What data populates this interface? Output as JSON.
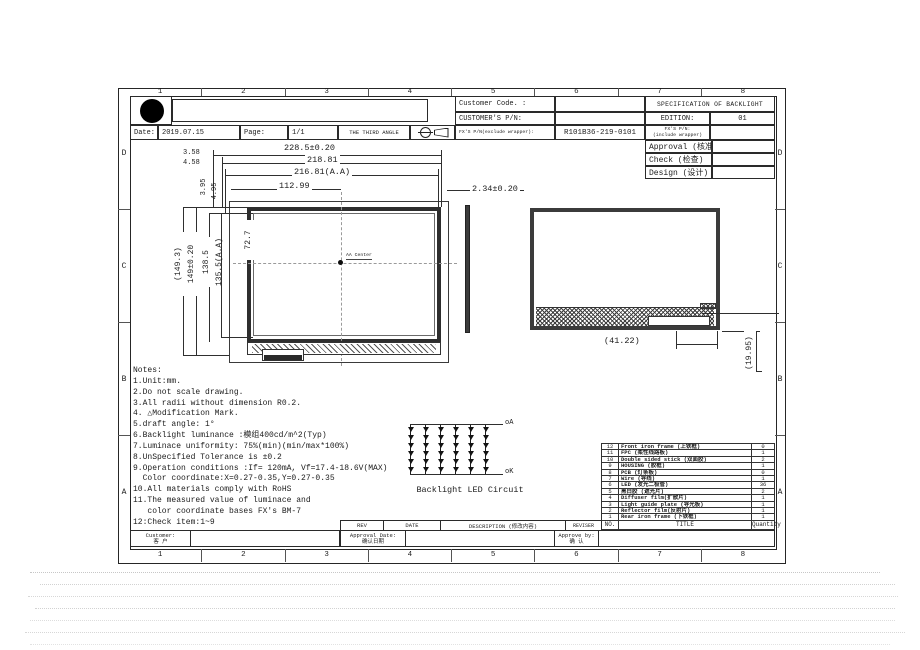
{
  "colors": {
    "ink": "#1c1c1c",
    "paper": "#ffffff"
  },
  "sheet": {
    "zone_cols": [
      "1",
      "2",
      "3",
      "4",
      "5",
      "6",
      "7",
      "8"
    ],
    "zone_rows": [
      "D",
      "C",
      "B",
      "A"
    ]
  },
  "title_block": {
    "customer_code_label": "Customer Code. :",
    "customer_pn_label": "CUSTOMER'S P/N:",
    "spec_title": "SPECIFICATION OF BACKLIGHT",
    "edition_label": "EDITION:",
    "edition_value": "01",
    "date_label": "Date:",
    "date_value": "2019.07.15",
    "page_label": "Page:",
    "page_value": "1/1",
    "third_angle_label": "THE THIRD ANGLE",
    "fx_pn_exclude_label": "FX'S P/N(exclude wrapper):",
    "fx_pn_value": "R101B36-219-0101",
    "fx_pn_include_label_1": "FX'S P/N:",
    "fx_pn_include_label_2": "(include wrapper)",
    "approval_label": "Approval (核准)",
    "check_label": "Check (检查)",
    "design_label": "Design (设计)"
  },
  "dims": {
    "width_overall": "228.5±0.20",
    "width_outline": "218.81",
    "width_aa": "216.81(A.A)",
    "width_half": "112.99",
    "top_offset1": "3.58",
    "top_offset2": "4.58",
    "side_offset1": "3.95",
    "side_offset2": "4.95",
    "height_overall_ref": "(149.3)",
    "height_overall": "149±0.20",
    "height_outline": "138.5",
    "height_aa": "135.5(A.A)",
    "height_half": "72.7",
    "thickness": "2.34±0.20",
    "fpc_offset": "(41.22)",
    "fpc_height": "(19.95)",
    "aa_center_label": "AA Center"
  },
  "notes": {
    "lines": [
      "Notes:",
      "1.Unit:mm.",
      "2.Do not scale drawing.",
      "3.All radii without dimension R0.2.",
      "4. △Modification Mark.",
      "5.draft angle: 1°",
      "6.Backlight luminance :模组400cd/m^2(Typ)",
      "7.Luminace uniformity: 75%(min)(min/max*100%)",
      "8.UnSpecified Tolerance is ±0.2",
      "9.Operation conditions :If= 120mA, Vf=17.4-18.6V(MAX)",
      "  Color coordinate:X=0.27-0.35,Y=0.27-0.35",
      "10.All materials comply with RoHS",
      "11.The measured value of luminace and",
      "   color coordinate bases FX's BM-7",
      "12:Check item:1~9"
    ]
  },
  "led_circuit": {
    "anode_label": "oA",
    "cathode_label": "oK",
    "caption": "Backlight LED Circuit",
    "columns": 6,
    "rows_per_column": 6
  },
  "parts_table": {
    "header": {
      "no": "NO.",
      "title": "TITLE",
      "qty": "Quantity"
    },
    "rows": [
      {
        "no": "12",
        "title": "Front iron frame (上铁框)",
        "qty": "0"
      },
      {
        "no": "11",
        "title": "FPC (柔性线路板)",
        "qty": "1"
      },
      {
        "no": "10",
        "title": "Double sided stick (双面胶)",
        "qty": "2"
      },
      {
        "no": "9",
        "title": "HOUSING (胶框)",
        "qty": "1"
      },
      {
        "no": "8",
        "title": "PCB (灯条板)",
        "qty": "0"
      },
      {
        "no": "7",
        "title": "Wire (导线)",
        "qty": "1"
      },
      {
        "no": "6",
        "title": "LED (发光二极管)",
        "qty": "36"
      },
      {
        "no": "5",
        "title": "黑白胶 (遮光片)",
        "qty": "2"
      },
      {
        "no": "4",
        "title": "Diffuser film(扩散片)",
        "qty": "1"
      },
      {
        "no": "3",
        "title": "Light guide plate (导光板)",
        "qty": "1"
      },
      {
        "no": "2",
        "title": "Reflector film(反射片)",
        "qty": "1"
      },
      {
        "no": "1",
        "title": "Rear iron frame (下铁框)",
        "qty": "1"
      }
    ]
  },
  "revision_table": {
    "rev_label": "REV",
    "date_label": "DATE",
    "description_label": "DESCRIPTION  (修改内容)",
    "reviser_label": "REVISER",
    "approval_date_label": "Approval Date:",
    "approval_date_cn": "确认日期",
    "approve_by_label": "Approve by:",
    "approve_by_cn": "确 认"
  },
  "footer_left": {
    "customer_label": "Customer:",
    "customer_cn": "客 户"
  }
}
